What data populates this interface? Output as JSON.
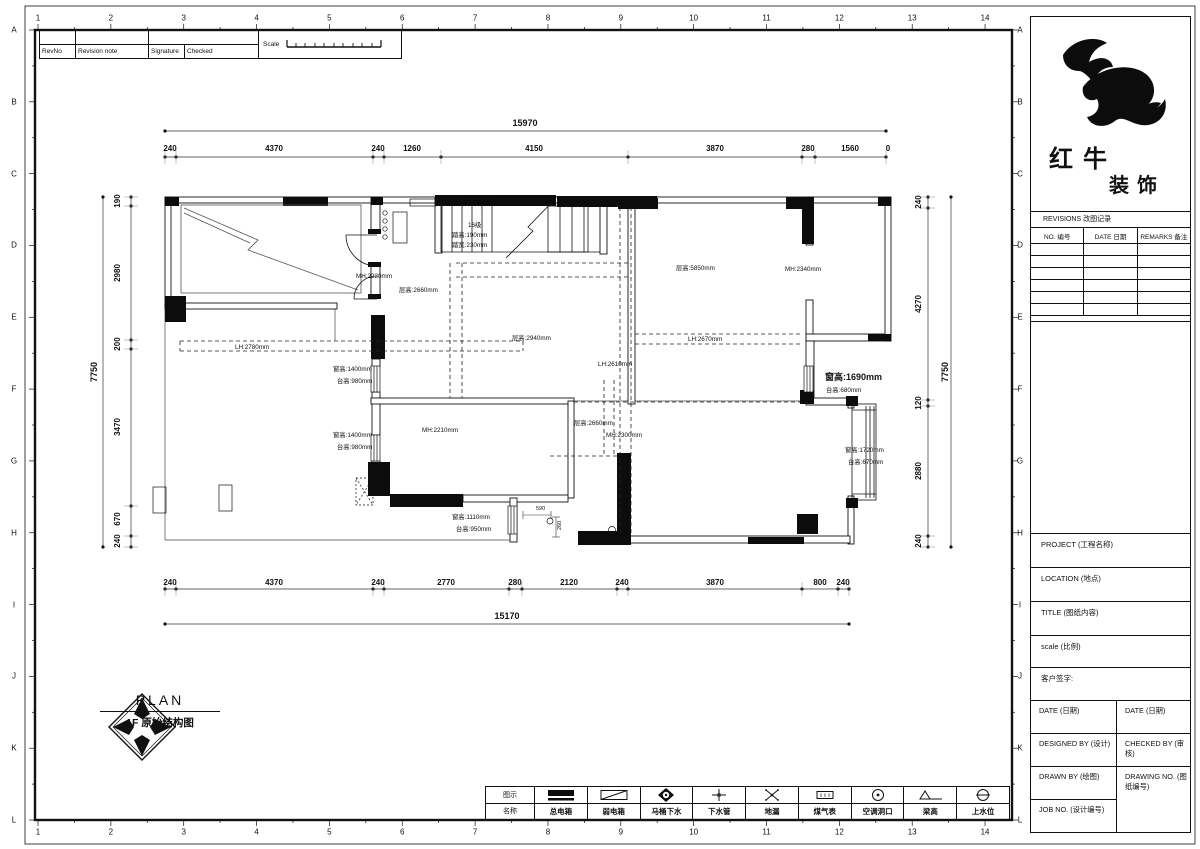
{
  "sheet": {
    "grid_numbers": [
      "1",
      "2",
      "3",
      "4",
      "5",
      "6",
      "7",
      "8",
      "9",
      "10",
      "11",
      "12",
      "13",
      "14"
    ],
    "grid_letters": [
      "A",
      "B",
      "C",
      "D",
      "E",
      "F",
      "G",
      "H",
      "I",
      "J",
      "K",
      "L"
    ]
  },
  "rev_strip": {
    "headers": [
      "RevNo",
      "Revision note",
      "Signature",
      "Checked"
    ],
    "scale_label": "Scale"
  },
  "title_block": {
    "brand_line1": "红牛",
    "brand_line2": "装饰",
    "revisions_title": "REVISIONS 改图记录",
    "rev_cols": [
      "NO. 编号",
      "DATE 日期",
      "REMARKS 备注"
    ],
    "rev_empty_rows": 6,
    "fields": {
      "project": "PROJECT (工程名称)",
      "location": "LOCATION (地点)",
      "title": "TITLE (图纸内容)",
      "scale": "scale (比例)",
      "client_sign": "客户签字:",
      "date_left": "DATE (日期)",
      "date_right": "DATE (日期)",
      "designed_by": "DESIGNED BY (设计)",
      "checked_by": "CHECKED BY (审核)",
      "drawn_by": "DRAWN BY (绘图)",
      "drawing_no": "DRAWING NO. (图纸编号)",
      "job_no": "JOB NO. (设计编号)"
    }
  },
  "plan_caption": {
    "compass_letters": [
      "A",
      "B",
      "C",
      "D"
    ],
    "plan_label": "PLAN",
    "subtitle": "1F 原始结构图"
  },
  "legend": {
    "header_symbol": "图示",
    "header_name": "名称",
    "items": [
      {
        "name": "总电箱",
        "icon": "main-electric-box-icon"
      },
      {
        "name": "弱电箱",
        "icon": "weak-electric-box-icon"
      },
      {
        "name": "马桶下水",
        "icon": "toilet-drain-icon"
      },
      {
        "name": "下水管",
        "icon": "drain-pipe-icon"
      },
      {
        "name": "地漏",
        "icon": "floor-drain-icon"
      },
      {
        "name": "煤气表",
        "icon": "gas-meter-icon"
      },
      {
        "name": "空调洞口",
        "icon": "ac-opening-icon"
      },
      {
        "name": "梁高",
        "icon": "beam-height-icon"
      },
      {
        "name": "上水位",
        "icon": "water-supply-icon"
      }
    ]
  },
  "dimensions": {
    "top_overall": {
      "t": "15970",
      "x": 525,
      "y": 126
    },
    "top_segments": [
      {
        "t": "240",
        "x": 170,
        "y": 151
      },
      {
        "t": "4370",
        "x": 274,
        "y": 151
      },
      {
        "t": "240",
        "x": 378,
        "y": 151
      },
      {
        "t": "1260",
        "x": 412,
        "y": 151
      },
      {
        "t": "4150",
        "x": 534,
        "y": 151
      },
      {
        "t": "3870",
        "x": 715,
        "y": 151
      },
      {
        "t": "280",
        "x": 808,
        "y": 151
      },
      {
        "t": "1560",
        "x": 850,
        "y": 151
      },
      {
        "t": "0",
        "x": 888,
        "y": 151
      }
    ],
    "bottom_segments": [
      {
        "t": "240",
        "x": 170,
        "y": 585
      },
      {
        "t": "4370",
        "x": 274,
        "y": 585
      },
      {
        "t": "240",
        "x": 378,
        "y": 585
      },
      {
        "t": "2770",
        "x": 446,
        "y": 585
      },
      {
        "t": "280",
        "x": 515,
        "y": 585
      },
      {
        "t": "2120",
        "x": 569,
        "y": 585
      },
      {
        "t": "240",
        "x": 622,
        "y": 585
      },
      {
        "t": "3870",
        "x": 715,
        "y": 585
      },
      {
        "t": "800",
        "x": 820,
        "y": 585
      },
      {
        "t": "240",
        "x": 843,
        "y": 585
      }
    ],
    "bottom_overall": {
      "t": "15170",
      "x": 507,
      "y": 619
    },
    "left_segments": [
      {
        "t": "190",
        "x": 120,
        "y": 201,
        "rot": -90
      },
      {
        "t": "2980",
        "x": 120,
        "y": 273,
        "rot": -90
      },
      {
        "t": "200",
        "x": 120,
        "y": 344,
        "rot": -90
      },
      {
        "t": "3470",
        "x": 120,
        "y": 427,
        "rot": -90
      },
      {
        "t": "670",
        "x": 120,
        "y": 519,
        "rot": -90
      },
      {
        "t": "240",
        "x": 120,
        "y": 541,
        "rot": -90
      }
    ],
    "left_overall": {
      "t": "7750",
      "x": 97,
      "y": 372,
      "rot": -90
    },
    "right_segments": [
      {
        "t": "240",
        "x": 921,
        "y": 202,
        "rot": -90
      },
      {
        "t": "4270",
        "x": 921,
        "y": 304,
        "rot": -90
      },
      {
        "t": "120",
        "x": 921,
        "y": 403,
        "rot": -90
      },
      {
        "t": "2880",
        "x": 921,
        "y": 471,
        "rot": -90
      },
      {
        "t": "240",
        "x": 921,
        "y": 541,
        "rot": -90
      }
    ],
    "right_overall": {
      "t": "7750",
      "x": 948,
      "y": 372,
      "rot": -90
    }
  },
  "annotations": [
    {
      "t": "16级",
      "x": 468,
      "y": 227
    },
    {
      "t": "踏高:190mm",
      "x": 452,
      "y": 237
    },
    {
      "t": "踏宽:230mm",
      "x": 452,
      "y": 247
    },
    {
      "t": "MH:2230mm",
      "x": 356,
      "y": 278
    },
    {
      "t": "层高:2660mm",
      "x": 399,
      "y": 292
    },
    {
      "t": "层高:2940mm",
      "x": 512,
      "y": 340
    },
    {
      "t": "层高:5850mm",
      "x": 676,
      "y": 270
    },
    {
      "t": "MH:2340mm",
      "x": 785,
      "y": 271
    },
    {
      "t": "LH:2670mm",
      "x": 688,
      "y": 341
    },
    {
      "t": "LH:2780mm",
      "x": 235,
      "y": 349
    },
    {
      "t": "LH:2610mm",
      "x": 598,
      "y": 366
    },
    {
      "t": "窗高:1400mm",
      "x": 333,
      "y": 371
    },
    {
      "t": "台高:980mm",
      "x": 337,
      "y": 383
    },
    {
      "t": "窗高:1400mm",
      "x": 333,
      "y": 437
    },
    {
      "t": "台高:980mm",
      "x": 337,
      "y": 449
    },
    {
      "t": "MH:2210mm",
      "x": 422,
      "y": 432
    },
    {
      "t": "层高:2660mm",
      "x": 574,
      "y": 425
    },
    {
      "t": "MH:2300mm",
      "x": 606,
      "y": 437
    },
    {
      "t": "窗高:1690mm",
      "x": 825,
      "y": 380,
      "em": true
    },
    {
      "t": "台高:680mm",
      "x": 826,
      "y": 392
    },
    {
      "t": "窗高:1720mm",
      "x": 845,
      "y": 452
    },
    {
      "t": "台高:670mm",
      "x": 848,
      "y": 464
    },
    {
      "t": "窗高:1110mm",
      "x": 452,
      "y": 519
    },
    {
      "t": "台高:950mm",
      "x": 456,
      "y": 531
    },
    {
      "t": "590",
      "x": 536,
      "y": 510,
      "s": 5.5
    },
    {
      "t": "260",
      "x": 561,
      "y": 530,
      "s": 5.5,
      "rot": -90
    }
  ]
}
